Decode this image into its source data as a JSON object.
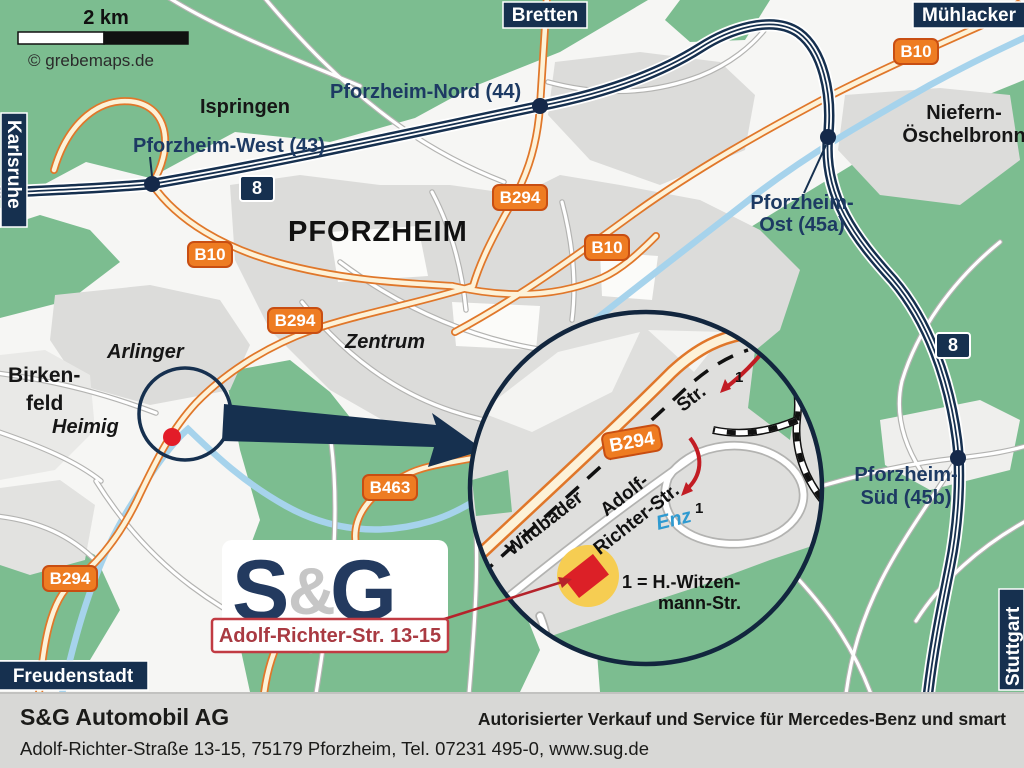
{
  "colors": {
    "navy": "#16304f",
    "exit_text": "#1d3a63",
    "badge_orange": "#ee7c22",
    "badge_border": "#c84e12",
    "forest_green": "#7cbd90",
    "urban_gray": "#dcdcda",
    "road_casing": "#b3b3b1",
    "river_blue": "#a6d3ec",
    "marker_red": "#dc2027",
    "address_red": "#a93a42",
    "footer_bg": "#d8d8d6"
  },
  "map": {
    "scale_label": "2 km",
    "copyright": "© grebemaps.de",
    "edge_labels": {
      "left": "Karlsruhe",
      "top": "Bretten",
      "top_right": "Mühlacker",
      "right": "Stuttgart",
      "bottom_left": "Freudenstadt"
    },
    "places": {
      "ispringen": "Ispringen",
      "pforzheim": "PFORZHEIM",
      "niefern_line1": "Niefern-",
      "niefern_line2": "Öschelbronn",
      "arlinger": "Arlinger",
      "zentrum": "Zentrum",
      "heimig": "Heimig",
      "birkenfeld_line1": "Birken-",
      "birkenfeld_line2": "feld"
    },
    "exits": {
      "west": "Pforzheim-West (43)",
      "nord": "Pforzheim-Nord (44)",
      "ost_line1": "Pforzheim-",
      "ost_line2": "Ost (45a)",
      "sued_line1": "Pforzheim-",
      "sued_line2": "Süd (45b)"
    },
    "badges": {
      "a8": "8",
      "b10": "B10",
      "b294": "B294",
      "b463": "B463"
    },
    "detail": {
      "street_wildbader": "Wildbader",
      "street_str": "Str.",
      "street_adolf_line1": "Adolf-",
      "street_adolf_line2": "Richter-Str.",
      "river": "Enz",
      "badge": "B294",
      "legend_line1": "1 = H.-Witzen-",
      "legend_line2": "mann-Str.",
      "marker_number": "1"
    },
    "logo": {
      "s": "S",
      "amp": "&",
      "g": "G"
    },
    "address_box": "Adolf-Richter-Str. 13-15"
  },
  "footer": {
    "company": "S&G Automobil AG",
    "tagline": "Autorisierter Verkauf und Service für Mercedes-Benz und smart",
    "address": "Adolf-Richter-Straße 13-15, 75179 Pforzheim, Tel. 07231 495-0, www.sug.de"
  }
}
